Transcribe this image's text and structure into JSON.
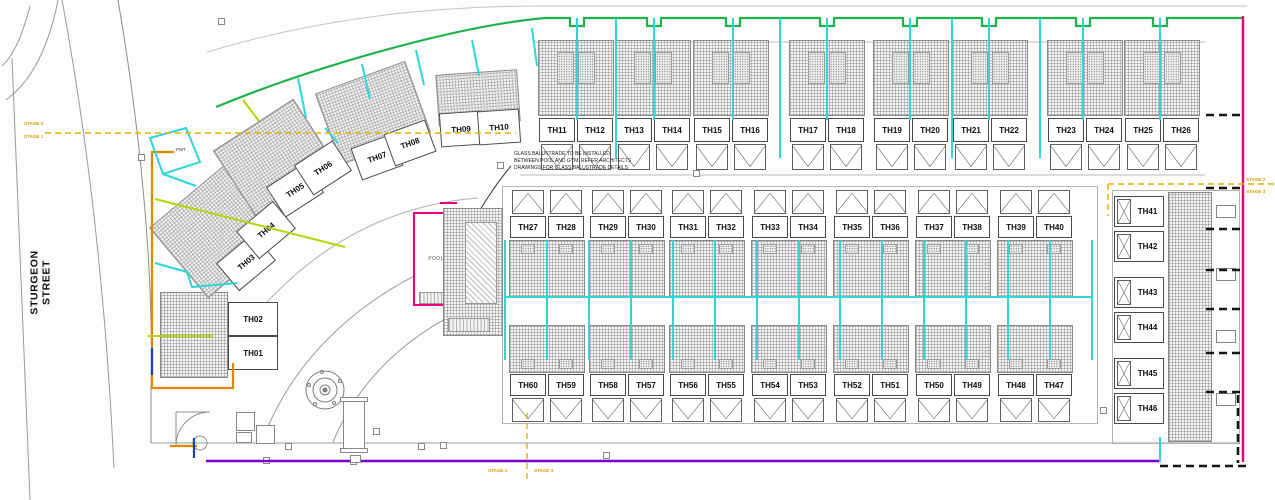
{
  "street": {
    "label": "STURGEON STREET"
  },
  "pmt": {
    "label": "PMT"
  },
  "pool": {
    "label": "POOL"
  },
  "annotation": {
    "lines": [
      "GLASS BALUSTRADE TO BE INSTALLED",
      "BETWEEN POOL AND GYM. REFER ARCHITECTS",
      "DRAWINGS FOR GLASS BALUSTRADE DETAILS"
    ]
  },
  "stages": {
    "left_top": "STAGE 2",
    "left_bottom": "STAGE 1",
    "right_top": "STAGE 2",
    "right_bottom": "STAGE 3",
    "bottom_left": "STAGE 1",
    "bottom_right": "STAGE 3"
  },
  "units": {
    "curve": [
      "TH01",
      "TH02",
      "TH03",
      "TH04",
      "TH05",
      "TH06",
      "TH07",
      "TH08",
      "TH09",
      "TH10"
    ],
    "top_row": [
      "TH11",
      "TH12",
      "TH13",
      "TH14",
      "TH15",
      "TH16",
      "TH17",
      "TH18",
      "TH19",
      "TH20",
      "TH21",
      "TH22",
      "TH23",
      "TH24",
      "TH25",
      "TH26"
    ],
    "mid_row": [
      "TH27",
      "TH28",
      "TH29",
      "TH30",
      "TH31",
      "TH32",
      "TH33",
      "TH34",
      "TH35",
      "TH36",
      "TH37",
      "TH38",
      "TH39",
      "TH40"
    ],
    "right_col": [
      "TH41",
      "TH42",
      "TH43",
      "TH44",
      "TH45",
      "TH46"
    ],
    "bottom_row": [
      "TH60",
      "TH59",
      "TH58",
      "TH57",
      "TH56",
      "TH55",
      "TH54",
      "TH53",
      "TH52",
      "TH51",
      "TH50",
      "TH49",
      "TH48",
      "TH47"
    ]
  },
  "colors": {
    "boundary_green": "#1fb14b",
    "service_cyan": "#2fd6d6",
    "stage_yellow": "#e0b400",
    "stage_label_orange": "#d89c00",
    "pool_magenta": "#e6007e",
    "sewer_purple": "#7a00cc",
    "water_orange": "#e08900",
    "power_blue": "#1a3fbf",
    "driveway_yellowgreen": "#b8d400",
    "dashed_black": "#151515"
  }
}
